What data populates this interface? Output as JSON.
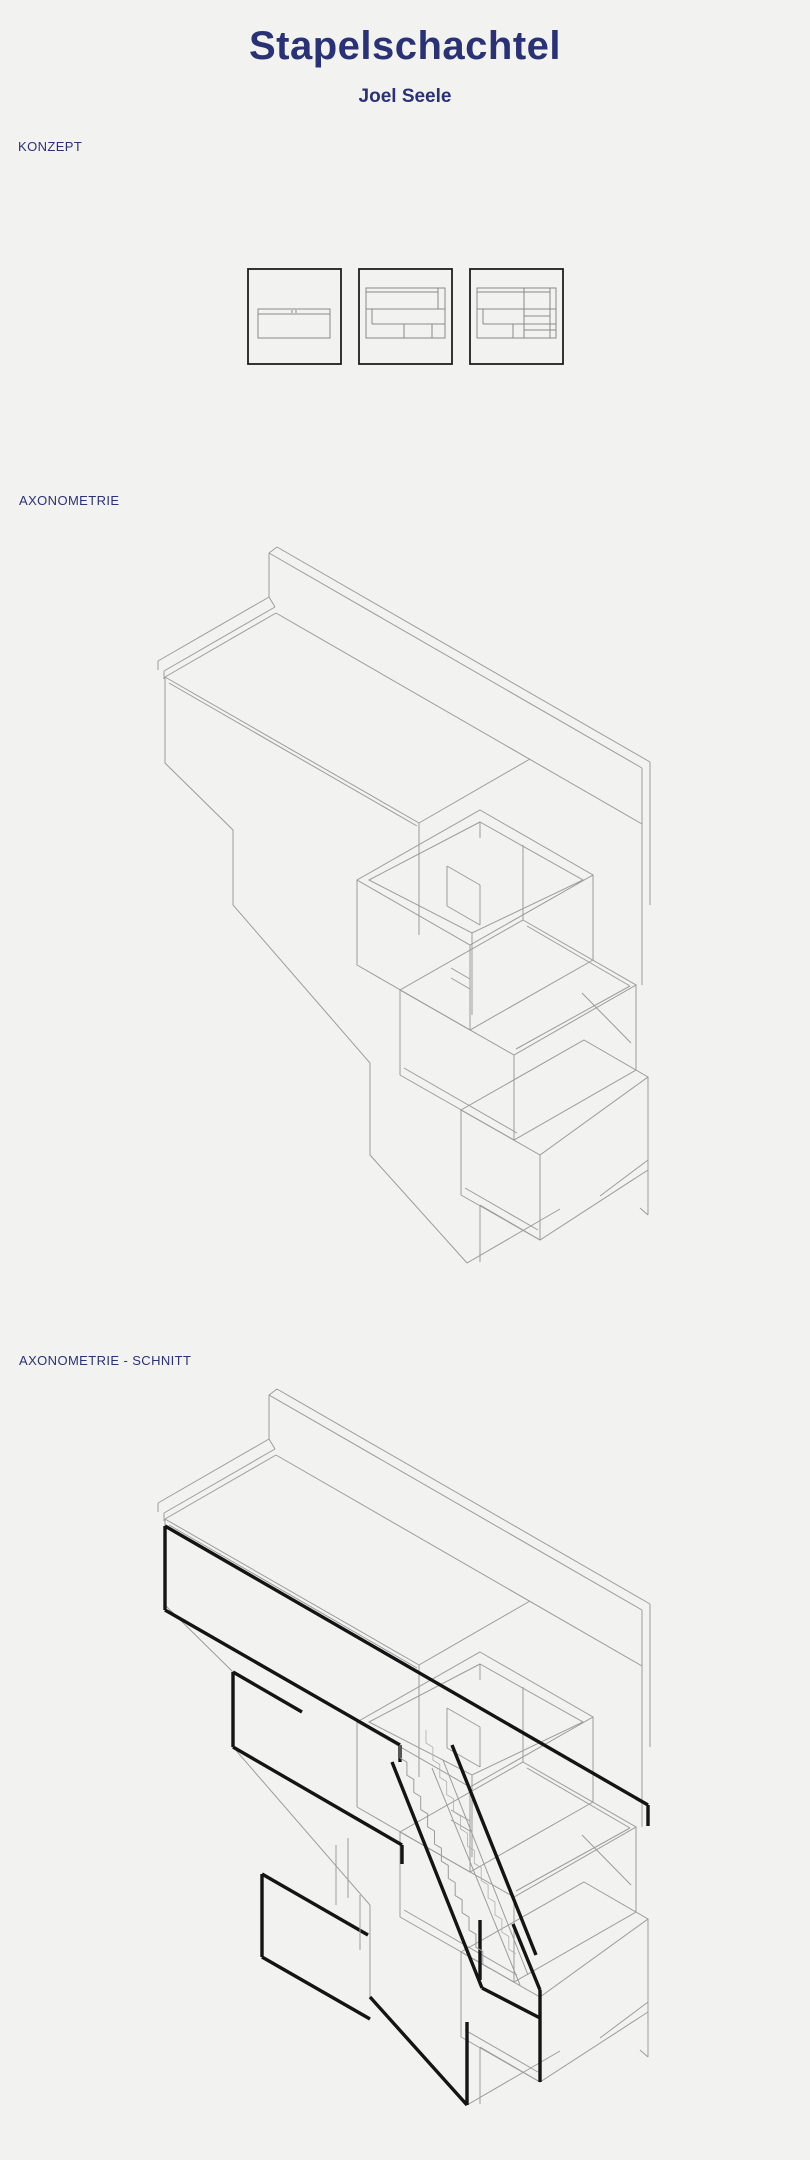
{
  "page": {
    "title": "Stapelschachtel",
    "author": "Joel Seele",
    "background_color": "#f2f2f1",
    "accent_color": "#2b3274",
    "drawing_line_color": "#9c9c9c",
    "section_cut_color": "#141414"
  },
  "sections": {
    "konzept": {
      "label": "KONZEPT"
    },
    "axonometrie": {
      "label": "AXONOMETRIE"
    },
    "schnitt": {
      "label": "AXONOMETRIE - SCHNITT"
    }
  },
  "figures": {
    "concept_diagrams_count": 3,
    "concept_description": "three stacked-box massing studies, increasingly subdivided",
    "axonometric": "isometric line drawing of stacked box volumes stepping down a slope",
    "axonometric_section": "same axonometric with bold black section cut and staircase"
  }
}
